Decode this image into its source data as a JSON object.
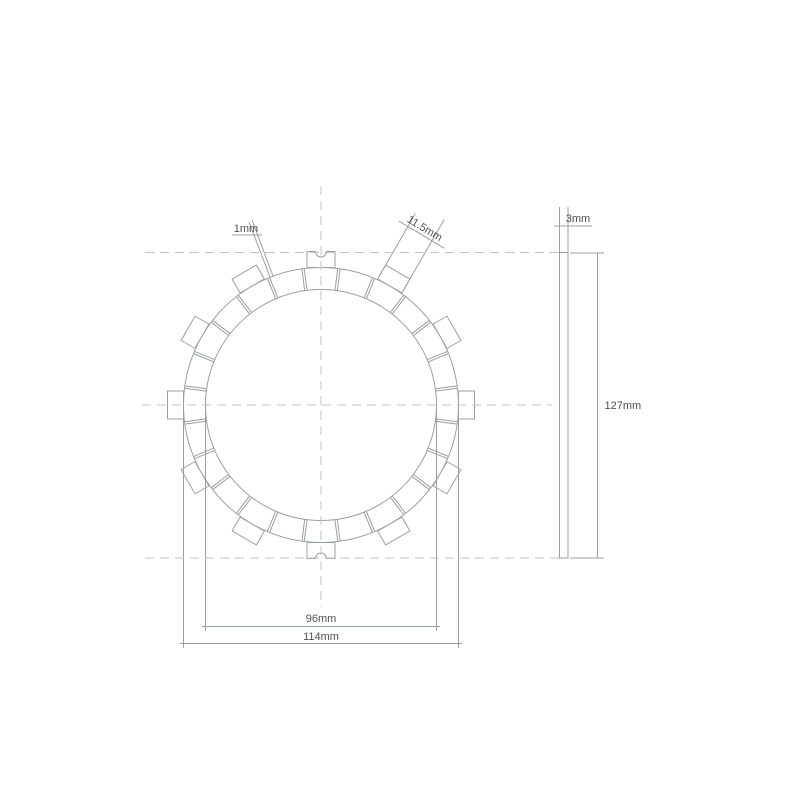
{
  "drawing": {
    "title": "Clutch friction plate technical drawing",
    "front_view": {
      "pad_segments": 24,
      "groove_first_angle_deg": 7.5,
      "groove_step_deg": 15,
      "tabs": 12,
      "tab_angle_step_deg": 30,
      "notched_tab_angles_deg": [
        0,
        180
      ]
    },
    "dimensions": {
      "groove_width": "1mm",
      "tab_width": "11.5mm",
      "friction_inner_diameter": "96mm",
      "friction_outer_diameter": "114mm",
      "thickness": "3mm",
      "overall_diameter": "127mm"
    },
    "colors": {
      "line": "#9aa0a0",
      "centerline": "#c0c4c4",
      "text": "#4f4f4f",
      "background": "#ffffff"
    }
  }
}
